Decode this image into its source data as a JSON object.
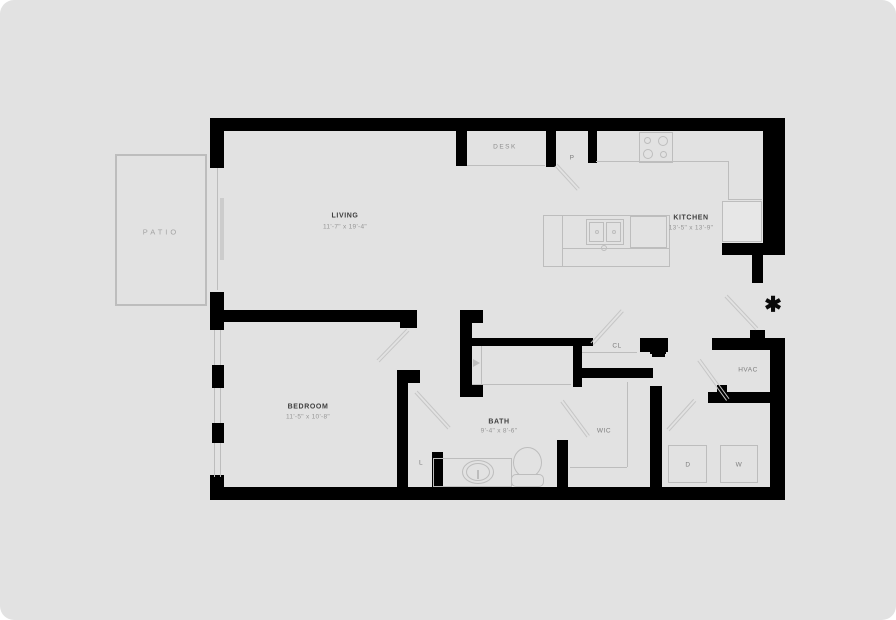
{
  "colors": {
    "canvas_bg": "#ffffff",
    "card_bg": "#e2e2e2",
    "wall": "#000000",
    "label_dark": "#3d3d3d",
    "label_gray": "#7d7d7d",
    "dims_gray": "#969696",
    "fixture_line": "#bdbdbd",
    "door_line": "#c6c6c6"
  },
  "rooms": {
    "patio": {
      "label": "PATIO"
    },
    "living": {
      "label": "LIVING",
      "dims": "11'-7\" x 19'-4\""
    },
    "kitchen": {
      "label": "KITCHEN",
      "dims": "13'-5\" x 13'-9\""
    },
    "bedroom": {
      "label": "BEDROOM",
      "dims": "11'-5\" x 10'-8\""
    },
    "bath": {
      "label": "BATH",
      "dims": "9'-4\" x 8'-6\""
    },
    "wic": {
      "label": "WIC"
    },
    "closet": {
      "label": "CL"
    },
    "hvac": {
      "label": "HVAC"
    },
    "desk": {
      "label": "DESK"
    },
    "pantry": {
      "label": "P"
    },
    "linen": {
      "label": "L"
    },
    "dryer": {
      "label": "D"
    },
    "washer": {
      "label": "W"
    }
  },
  "markers": {
    "entry_asterisk": "✱"
  }
}
